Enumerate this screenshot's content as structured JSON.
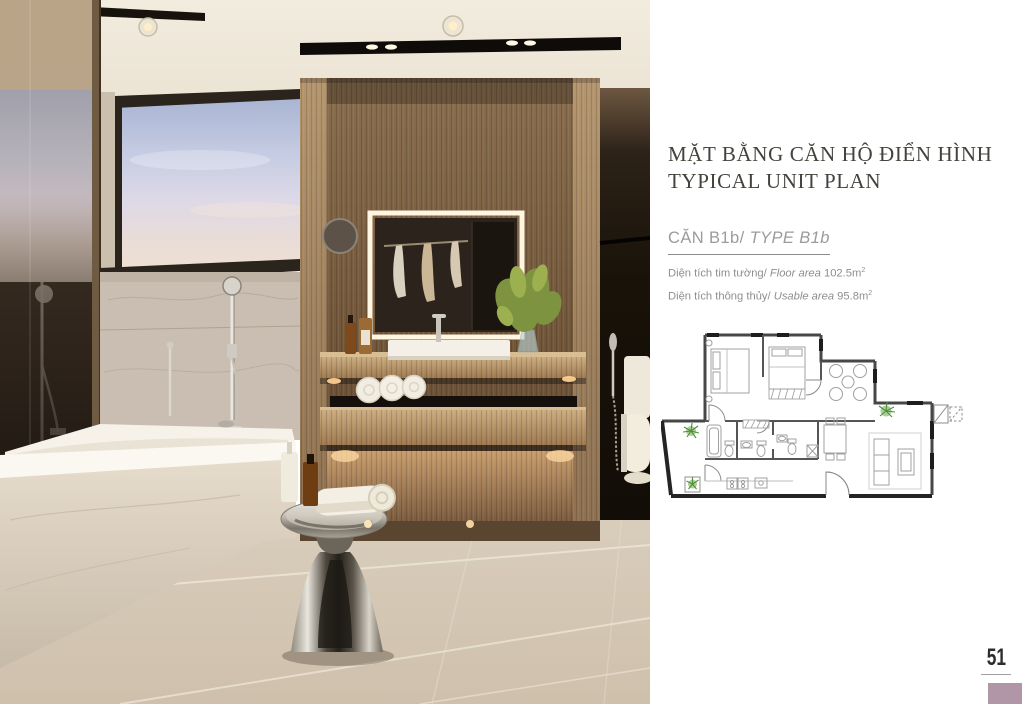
{
  "header": {
    "title_vi": "MẶT BẰNG CĂN HỘ ĐIỂN HÌNH",
    "title_en": "TYPICAL UNIT PLAN"
  },
  "unit": {
    "name_vi": "CĂN B1b/",
    "name_en": "TYPE B1b",
    "floor_area": {
      "label_vi": "Diện tích tim tường/",
      "label_en": "Floor area",
      "value": "102.5m",
      "sup": "2"
    },
    "usable_area": {
      "label_vi": "Diện tích thông thủy/",
      "label_en": "Usable area",
      "value": "95.8m",
      "sup": "2"
    }
  },
  "page": {
    "number": "51"
  },
  "colors": {
    "title_text": "#45423c",
    "muted_text": "#8f8e8c",
    "plan_wall": "#474747",
    "plan_plant_green": "#4e8f3a",
    "page_marker": "#b096a7"
  }
}
